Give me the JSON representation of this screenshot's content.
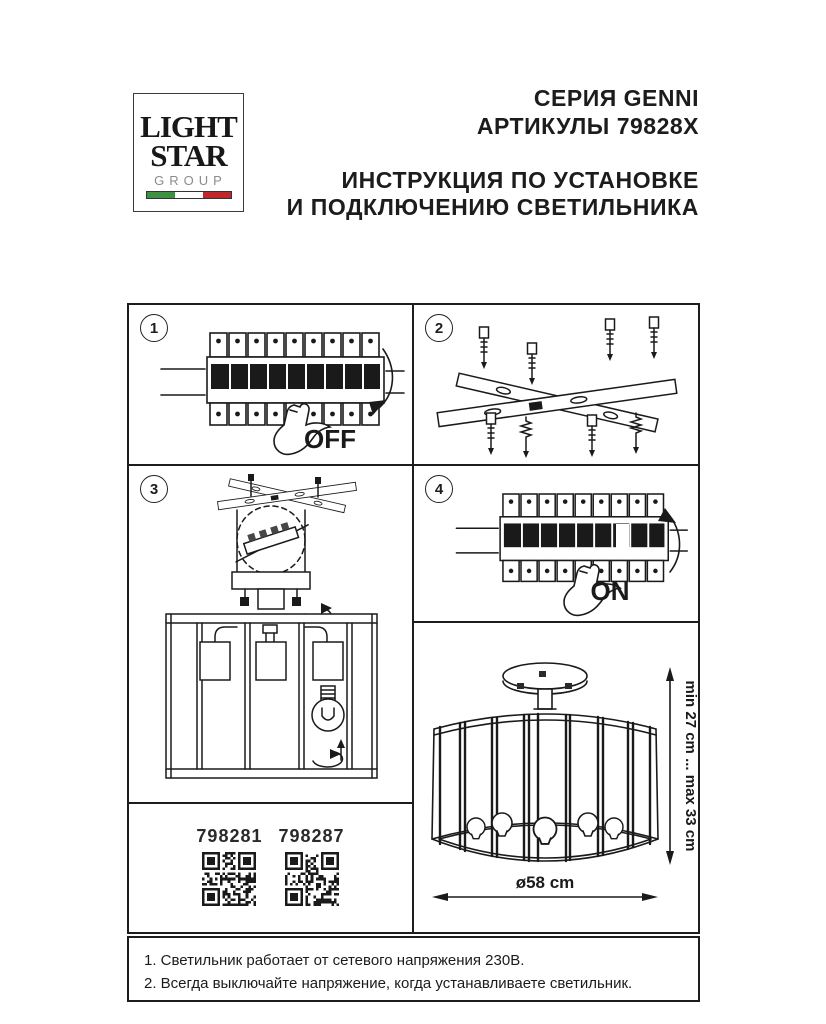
{
  "header": {
    "logo": {
      "line1": "LIGHT",
      "line2": "STAR",
      "line3": "GROUP"
    },
    "series": "СЕРИЯ GENNI",
    "articles": "АРТИКУЛЫ 79828X",
    "title1": "ИНСТРУКЦИЯ ПО УСТАНОВКЕ",
    "title2": "И ПОДКЛЮЧЕНИЮ СВЕТИЛЬНИКА"
  },
  "steps": {
    "s1": {
      "number": "1",
      "label": "OFF"
    },
    "s2": {
      "number": "2"
    },
    "s3": {
      "number": "3"
    },
    "s4": {
      "number": "4",
      "label": "ON"
    }
  },
  "codes": {
    "left": "798281",
    "right": "798287"
  },
  "dims": {
    "height": "min 27 cm ... max 33 cm",
    "diameter": "ø58 cm"
  },
  "notes": [
    "1. Светильник работает от сетевого напряжения 230В.",
    "2. Всегда выключайте напряжение, когда устанавливаете светильник."
  ],
  "colors": {
    "ink": "#1d1d1d",
    "flag_green": "#3f9142",
    "flag_red": "#c0272d",
    "group_gray": "#8c8c8c"
  }
}
